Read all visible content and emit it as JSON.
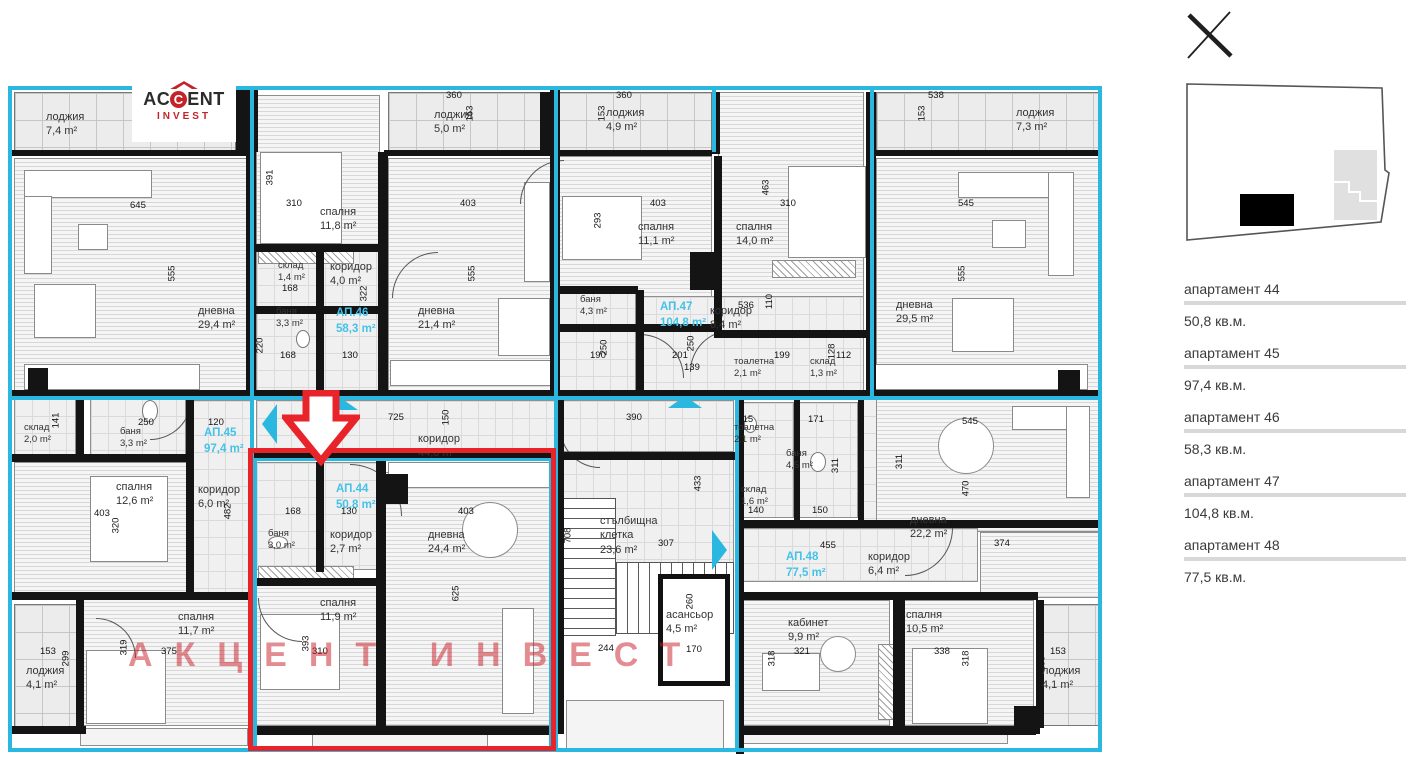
{
  "colors": {
    "cyan": "#2ab8e0",
    "red": "#e8232a",
    "apt_label": "#45c2e8"
  },
  "logo": {
    "name_pre": "AC",
    "name_c": "C",
    "name_post": "ENT",
    "sub": "INVEST"
  },
  "watermark": "АКЦЕНТ ИНВЕСТ",
  "close_label": "close",
  "sidebar": {
    "items": [
      {
        "title": "апартамент 44",
        "area": "50,8 кв.м."
      },
      {
        "title": "апартамент 45",
        "area": "97,4 кв.м."
      },
      {
        "title": "апартамент 46",
        "area": "58,3 кв.м."
      },
      {
        "title": "апартамент 47",
        "area": "104,8 кв.м."
      },
      {
        "title": "апартамент 48",
        "area": "77,5 кв.м."
      }
    ]
  },
  "plan": {
    "highlighted_apartment": "АП.44",
    "apts": [
      {
        "n": "АП.44",
        "a": "50,8 m²",
        "x": 336,
        "y": 482
      },
      {
        "n": "АП.45",
        "a": "97,4 m²",
        "x": 204,
        "y": 426
      },
      {
        "n": "АП.46",
        "a": "58,3 m²",
        "x": 336,
        "y": 306
      },
      {
        "n": "АП.47",
        "a": "104,8 m²",
        "x": 660,
        "y": 300
      },
      {
        "n": "АП.48",
        "a": "77,5 m²",
        "x": 786,
        "y": 550
      }
    ],
    "rooms": [
      {
        "n": "лоджия",
        "a": "7,4 m²",
        "x": 46,
        "y": 110
      },
      {
        "n": "дневна",
        "a": "29,4 m²",
        "x": 198,
        "y": 304
      },
      {
        "n": "спалня",
        "a": "11,8 m²",
        "x": 320,
        "y": 205
      },
      {
        "n": "лоджия",
        "a": "5,0 m²",
        "x": 434,
        "y": 108
      },
      {
        "n": "склад",
        "a": "1,4 m²",
        "x": 278,
        "y": 260,
        "s": 1
      },
      {
        "n": "коридор",
        "a": "4,0 m²",
        "x": 330,
        "y": 260
      },
      {
        "n": "баня",
        "a": "3,3 m²",
        "x": 276,
        "y": 306,
        "s": 1
      },
      {
        "n": "дневна",
        "a": "21,4 m²",
        "x": 418,
        "y": 304
      },
      {
        "n": "лоджия",
        "a": "4,9 m²",
        "x": 606,
        "y": 106
      },
      {
        "n": "спалня",
        "a": "11,1 m²",
        "x": 638,
        "y": 220
      },
      {
        "n": "спалня",
        "a": "14,0 m²",
        "x": 736,
        "y": 220
      },
      {
        "n": "баня",
        "a": "4,3 m²",
        "x": 580,
        "y": 294,
        "s": 1
      },
      {
        "n": "коридор",
        "a": "8,4 m²",
        "x": 710,
        "y": 304
      },
      {
        "n": "тоалетна",
        "a": "2,1 m²",
        "x": 734,
        "y": 356,
        "s": 1
      },
      {
        "n": "склад",
        "a": "1,3 m²",
        "x": 810,
        "y": 356,
        "s": 1
      },
      {
        "n": "лоджия",
        "a": "7,3 m²",
        "x": 1016,
        "y": 106
      },
      {
        "n": "дневна",
        "a": "29,5 m²",
        "x": 896,
        "y": 298
      },
      {
        "n": "склад",
        "a": "2,0 m²",
        "x": 24,
        "y": 422,
        "s": 1
      },
      {
        "n": "баня",
        "a": "3,3 m²",
        "x": 120,
        "y": 426,
        "s": 1
      },
      {
        "n": "коридор",
        "a": "44,0 m²",
        "x": 418,
        "y": 432
      },
      {
        "n": "спалня",
        "a": "12,6 m²",
        "x": 116,
        "y": 480
      },
      {
        "n": "коридор",
        "a": "6,0 m²",
        "x": 198,
        "y": 483
      },
      {
        "n": "баня",
        "a": "3,0 m²",
        "x": 268,
        "y": 528,
        "s": 1
      },
      {
        "n": "коридор",
        "a": "2,7 m²",
        "x": 330,
        "y": 528
      },
      {
        "n": "дневна",
        "a": "24,4 m²",
        "x": 428,
        "y": 528
      },
      {
        "n": "стълбищна клетка",
        "a": "23,6 m²",
        "x": 600,
        "y": 514,
        "wrap": 1
      },
      {
        "n": "асансьор",
        "a": "4,5 m²",
        "x": 666,
        "y": 608
      },
      {
        "n": "тоалетна",
        "a": "2,1 m²",
        "x": 734,
        "y": 422,
        "s": 1
      },
      {
        "n": "баня",
        "a": "4,5 m²",
        "x": 786,
        "y": 448,
        "s": 1
      },
      {
        "n": "склад",
        "a": "1,6 m²",
        "x": 741,
        "y": 484,
        "s": 1
      },
      {
        "n": "коридор",
        "a": "6,4 m²",
        "x": 868,
        "y": 550
      },
      {
        "n": "дневна",
        "a": "22,2 m²",
        "x": 910,
        "y": 513
      },
      {
        "n": "спалня",
        "a": "11,7 m²",
        "x": 178,
        "y": 610
      },
      {
        "n": "спалня",
        "a": "11,9 m²",
        "x": 320,
        "y": 596
      },
      {
        "n": "кабинет",
        "a": "9,9 m²",
        "x": 788,
        "y": 616
      },
      {
        "n": "спалня",
        "a": "10,5 m²",
        "x": 906,
        "y": 608
      },
      {
        "n": "лоджия",
        "a": "4,1 m²",
        "x": 26,
        "y": 664
      },
      {
        "n": "лоджия",
        "a": "4,1 m²",
        "x": 1042,
        "y": 664
      }
    ],
    "dims": [
      {
        "t": "153",
        "x": 162,
        "y": 106,
        "v": 1
      },
      {
        "t": "645",
        "x": 130,
        "y": 200
      },
      {
        "t": "555",
        "x": 164,
        "y": 268,
        "v": 1
      },
      {
        "t": "391",
        "x": 262,
        "y": 172,
        "v": 1
      },
      {
        "t": "310",
        "x": 286,
        "y": 198
      },
      {
        "t": "360",
        "x": 446,
        "y": 90
      },
      {
        "t": "153",
        "x": 462,
        "y": 108,
        "v": 1
      },
      {
        "t": "403",
        "x": 460,
        "y": 198
      },
      {
        "t": "555",
        "x": 464,
        "y": 268,
        "v": 1
      },
      {
        "t": "360",
        "x": 616,
        "y": 90
      },
      {
        "t": "153",
        "x": 594,
        "y": 108,
        "v": 1
      },
      {
        "t": "403",
        "x": 650,
        "y": 198
      },
      {
        "t": "293",
        "x": 590,
        "y": 215,
        "v": 1
      },
      {
        "t": "463",
        "x": 758,
        "y": 182,
        "v": 1
      },
      {
        "t": "310",
        "x": 780,
        "y": 198
      },
      {
        "t": "538",
        "x": 928,
        "y": 90
      },
      {
        "t": "153",
        "x": 914,
        "y": 108,
        "v": 1
      },
      {
        "t": "545",
        "x": 958,
        "y": 198
      },
      {
        "t": "555",
        "x": 954,
        "y": 268,
        "v": 1
      },
      {
        "t": "168",
        "x": 282,
        "y": 283
      },
      {
        "t": "322",
        "x": 356,
        "y": 288,
        "v": 1
      },
      {
        "t": "168",
        "x": 280,
        "y": 350
      },
      {
        "t": "130",
        "x": 342,
        "y": 350
      },
      {
        "t": "220",
        "x": 252,
        "y": 340,
        "v": 1
      },
      {
        "t": "190",
        "x": 590,
        "y": 350
      },
      {
        "t": "250",
        "x": 596,
        "y": 342,
        "v": 1
      },
      {
        "t": "201",
        "x": 672,
        "y": 350
      },
      {
        "t": "139",
        "x": 684,
        "y": 362
      },
      {
        "t": "250",
        "x": 683,
        "y": 338,
        "v": 1
      },
      {
        "t": "536",
        "x": 738,
        "y": 300
      },
      {
        "t": "110",
        "x": 762,
        "y": 296,
        "v": 1
      },
      {
        "t": "199",
        "x": 774,
        "y": 350
      },
      {
        "t": "128",
        "x": 824,
        "y": 346,
        "v": 1
      },
      {
        "t": "112",
        "x": 836,
        "y": 350
      },
      {
        "t": "725",
        "x": 388,
        "y": 412
      },
      {
        "t": "150",
        "x": 438,
        "y": 412,
        "v": 1
      },
      {
        "t": "390",
        "x": 626,
        "y": 412
      },
      {
        "t": "433",
        "x": 690,
        "y": 478,
        "v": 1
      },
      {
        "t": "307",
        "x": 658,
        "y": 538
      },
      {
        "t": "708",
        "x": 560,
        "y": 530,
        "v": 1
      },
      {
        "t": "244",
        "x": 598,
        "y": 643
      },
      {
        "t": "170",
        "x": 686,
        "y": 644
      },
      {
        "t": "260",
        "x": 682,
        "y": 596,
        "v": 1
      },
      {
        "t": "171",
        "x": 808,
        "y": 414
      },
      {
        "t": "115",
        "x": 738,
        "y": 414
      },
      {
        "t": "311",
        "x": 828,
        "y": 460,
        "v": 1
      },
      {
        "t": "311",
        "x": 892,
        "y": 456,
        "v": 1
      },
      {
        "t": "545",
        "x": 962,
        "y": 416
      },
      {
        "t": "470",
        "x": 958,
        "y": 483,
        "v": 1
      },
      {
        "t": "374",
        "x": 994,
        "y": 538
      },
      {
        "t": "455",
        "x": 820,
        "y": 540
      },
      {
        "t": "150",
        "x": 812,
        "y": 505
      },
      {
        "t": "140",
        "x": 748,
        "y": 505
      },
      {
        "t": "141",
        "x": 48,
        "y": 415,
        "v": 1
      },
      {
        "t": "250",
        "x": 138,
        "y": 417
      },
      {
        "t": "120",
        "x": 208,
        "y": 417
      },
      {
        "t": "403",
        "x": 94,
        "y": 508
      },
      {
        "t": "320",
        "x": 108,
        "y": 520,
        "v": 1
      },
      {
        "t": "482",
        "x": 220,
        "y": 506,
        "v": 1
      },
      {
        "t": "168",
        "x": 285,
        "y": 506
      },
      {
        "t": "130",
        "x": 341,
        "y": 506
      },
      {
        "t": "403",
        "x": 458,
        "y": 506
      },
      {
        "t": "625",
        "x": 448,
        "y": 588,
        "v": 1
      },
      {
        "t": "153",
        "x": 40,
        "y": 646
      },
      {
        "t": "299",
        "x": 58,
        "y": 653,
        "v": 1
      },
      {
        "t": "319",
        "x": 116,
        "y": 642,
        "v": 1
      },
      {
        "t": "375",
        "x": 161,
        "y": 646
      },
      {
        "t": "393",
        "x": 298,
        "y": 638,
        "v": 1
      },
      {
        "t": "310",
        "x": 312,
        "y": 646
      },
      {
        "t": "321",
        "x": 794,
        "y": 646
      },
      {
        "t": "318",
        "x": 764,
        "y": 653,
        "v": 1
      },
      {
        "t": "338",
        "x": 934,
        "y": 646
      },
      {
        "t": "318",
        "x": 958,
        "y": 653,
        "v": 1
      },
      {
        "t": "153",
        "x": 1050,
        "y": 646
      },
      {
        "t": "299",
        "x": 1034,
        "y": 658,
        "v": 1
      }
    ]
  }
}
